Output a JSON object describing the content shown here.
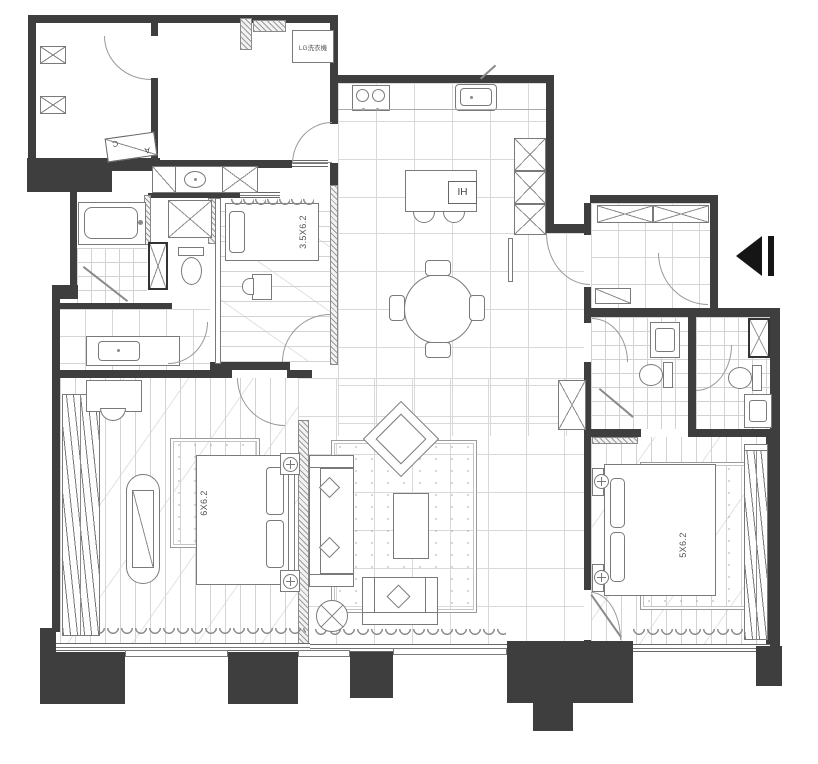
{
  "document": {
    "type": "apartment-floor-plan"
  },
  "labels": {
    "small_bedroom_bed_size": "3.5X6.2",
    "master_bedroom_bed_size": "6X6.2",
    "second_bedroom_bed_size": "5X6.2",
    "laundry_appliance": "LG洗衣機",
    "kitchen_island_hob": "IH",
    "section_marker_letter_top": "C",
    "section_marker_letter_bottom": "A"
  },
  "colors": {
    "wall": "#3e3e3e",
    "line": "#8a8a8a",
    "grid": "#d9d9d9",
    "floor": "#ffffff",
    "arrow": "#151515"
  },
  "icons": {
    "entry_arrow": "◀"
  }
}
